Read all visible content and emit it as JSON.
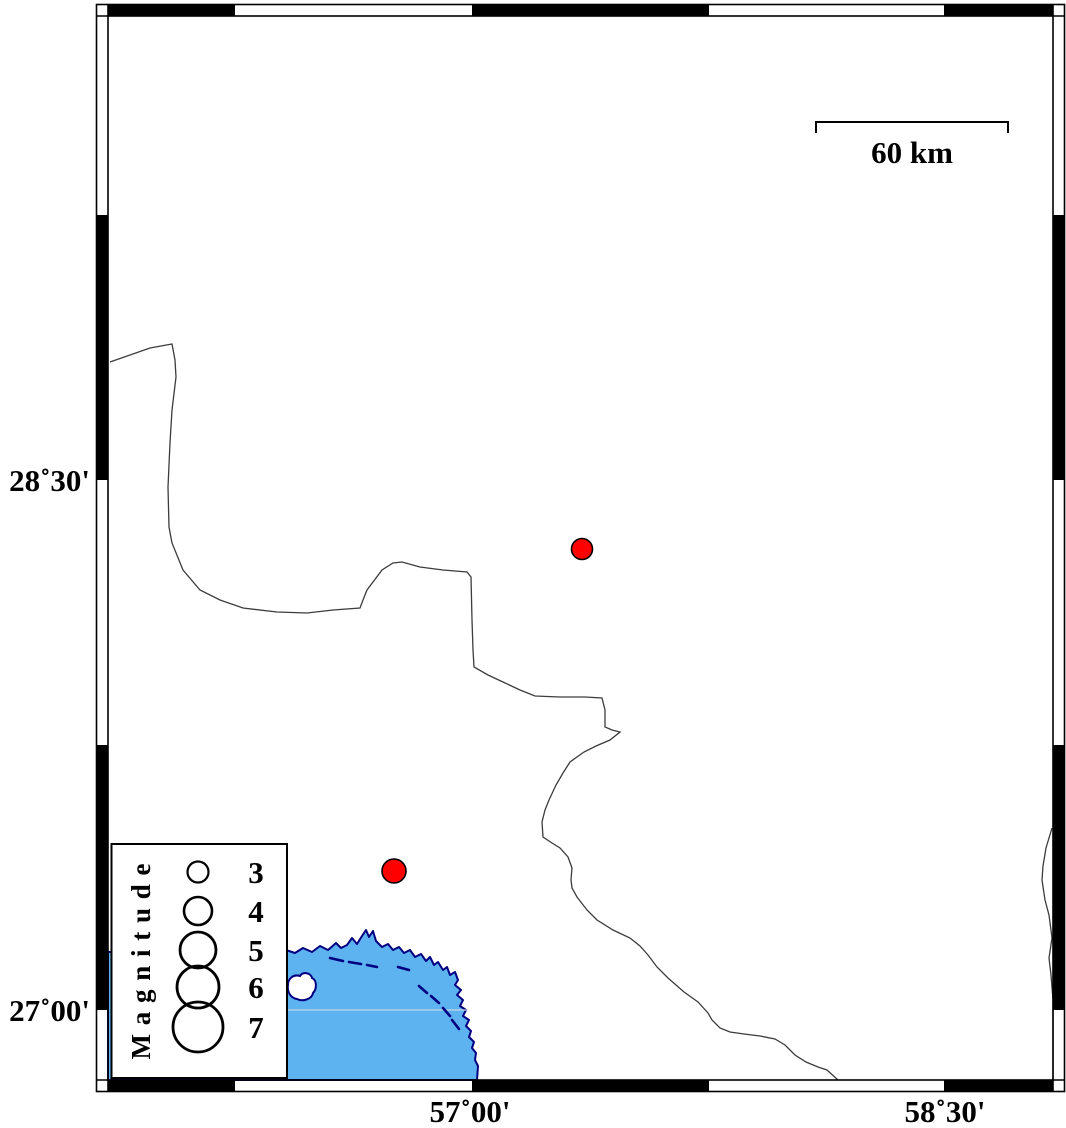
{
  "map": {
    "axis": {
      "left_labels": [
        "28˚30'",
        "27˚00'"
      ],
      "bottom_labels": [
        "57˚00'",
        "58˚30'"
      ]
    },
    "scalebar": {
      "label": "60 km"
    },
    "legend": {
      "title": "M a g n i t u d e",
      "items": [
        {
          "magnitude": "3",
          "radius": 10.5
        },
        {
          "magnitude": "4",
          "radius": 14
        },
        {
          "magnitude": "5",
          "radius": 18
        },
        {
          "magnitude": "6",
          "radius": 21
        },
        {
          "magnitude": "7",
          "radius": 25
        }
      ]
    },
    "epicenters": [
      {
        "x": 582,
        "y": 549,
        "r": 10.5
      },
      {
        "x": 394,
        "y": 871,
        "r": 12
      }
    ],
    "colors": {
      "sea": "#5db3f0",
      "coast": "#000080",
      "epicenter": "#ff0000",
      "boundary": "#3c3c3c",
      "frame": "#000000",
      "sea_gridline": "#c6d4e4"
    }
  }
}
